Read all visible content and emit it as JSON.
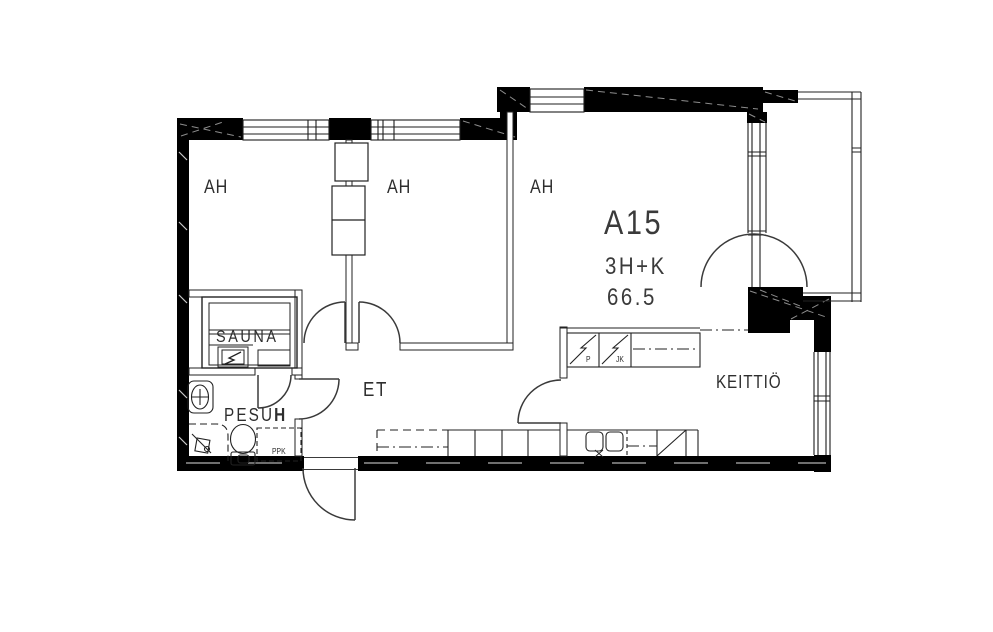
{
  "floorplan": {
    "apartment": {
      "id": "A15",
      "layout": "3H+K",
      "area": "66.5"
    },
    "rooms": [
      {
        "key": "bedroom-1",
        "label": "AH"
      },
      {
        "key": "bedroom-2",
        "label": "AH"
      },
      {
        "key": "living-room",
        "label": "AH"
      },
      {
        "key": "sauna",
        "label": "SAUNA"
      },
      {
        "key": "washroom",
        "label": "PESU",
        "label_bold": "H"
      },
      {
        "key": "hallway",
        "label": "ET"
      },
      {
        "key": "kitchen",
        "label": "KEITTIÖ"
      }
    ],
    "appliances": [
      {
        "key": "freezer-tall-unit",
        "label": "P"
      },
      {
        "key": "fridge-tall-unit",
        "label": "JK"
      },
      {
        "key": "washing-machine-reservation",
        "label": "PPK"
      }
    ],
    "colors": {
      "wall": "#000000",
      "line": "#222222",
      "hatch": "#8d8d8d"
    }
  }
}
